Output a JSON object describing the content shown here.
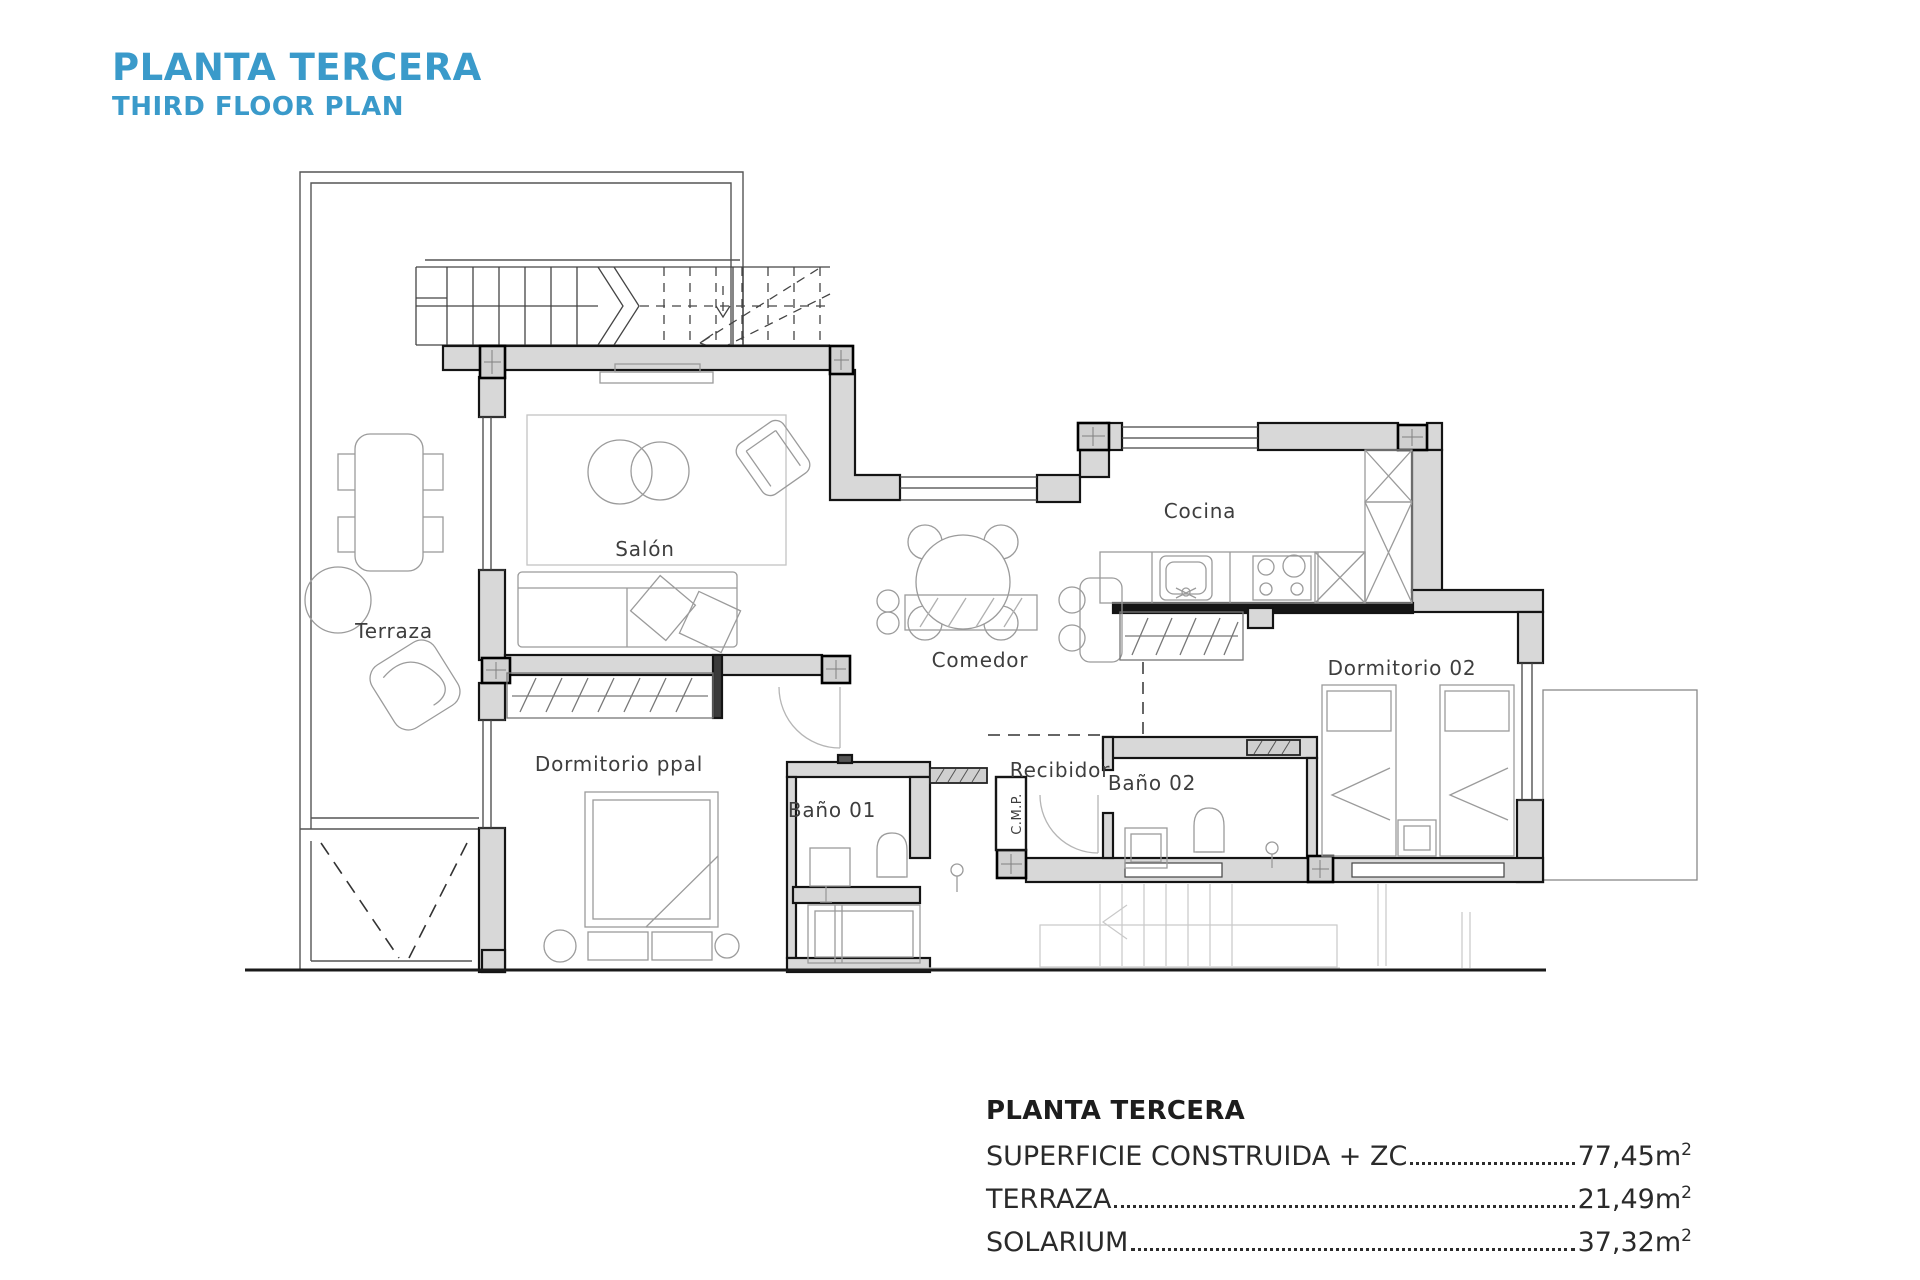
{
  "title": {
    "main": "PLANTA TERCERA",
    "sub": "THIRD FLOOR PLAN"
  },
  "rooms": {
    "terraza": "Terraza",
    "salon": "Salón",
    "comedor": "Comedor",
    "cocina": "Cocina",
    "dormitorio_ppal": "Dormitorio ppal",
    "dormitorio_02": "Dormitorio 02",
    "bano_01": "Baño 01",
    "bano_02": "Baño 02",
    "recibidor": "Recibidor",
    "cmp": "C.M.P."
  },
  "legend": {
    "heading": "PLANTA TERCERA",
    "rows": [
      {
        "label": "SUPERFICIE CONSTRUIDA + ZC",
        "value": "77,45m",
        "sup": "2"
      },
      {
        "label": "TERRAZA",
        "value": "21,49m",
        "sup": "2"
      },
      {
        "label": "SOLARIUM",
        "value": "37,32m",
        "sup": "2"
      }
    ]
  },
  "colors": {
    "accent_blue": "#3a9aca",
    "wall_fill": "#d8d8d8",
    "wall_stroke": "#141414",
    "thin_line": "#555555",
    "furniture_line": "#9b9b9b"
  }
}
